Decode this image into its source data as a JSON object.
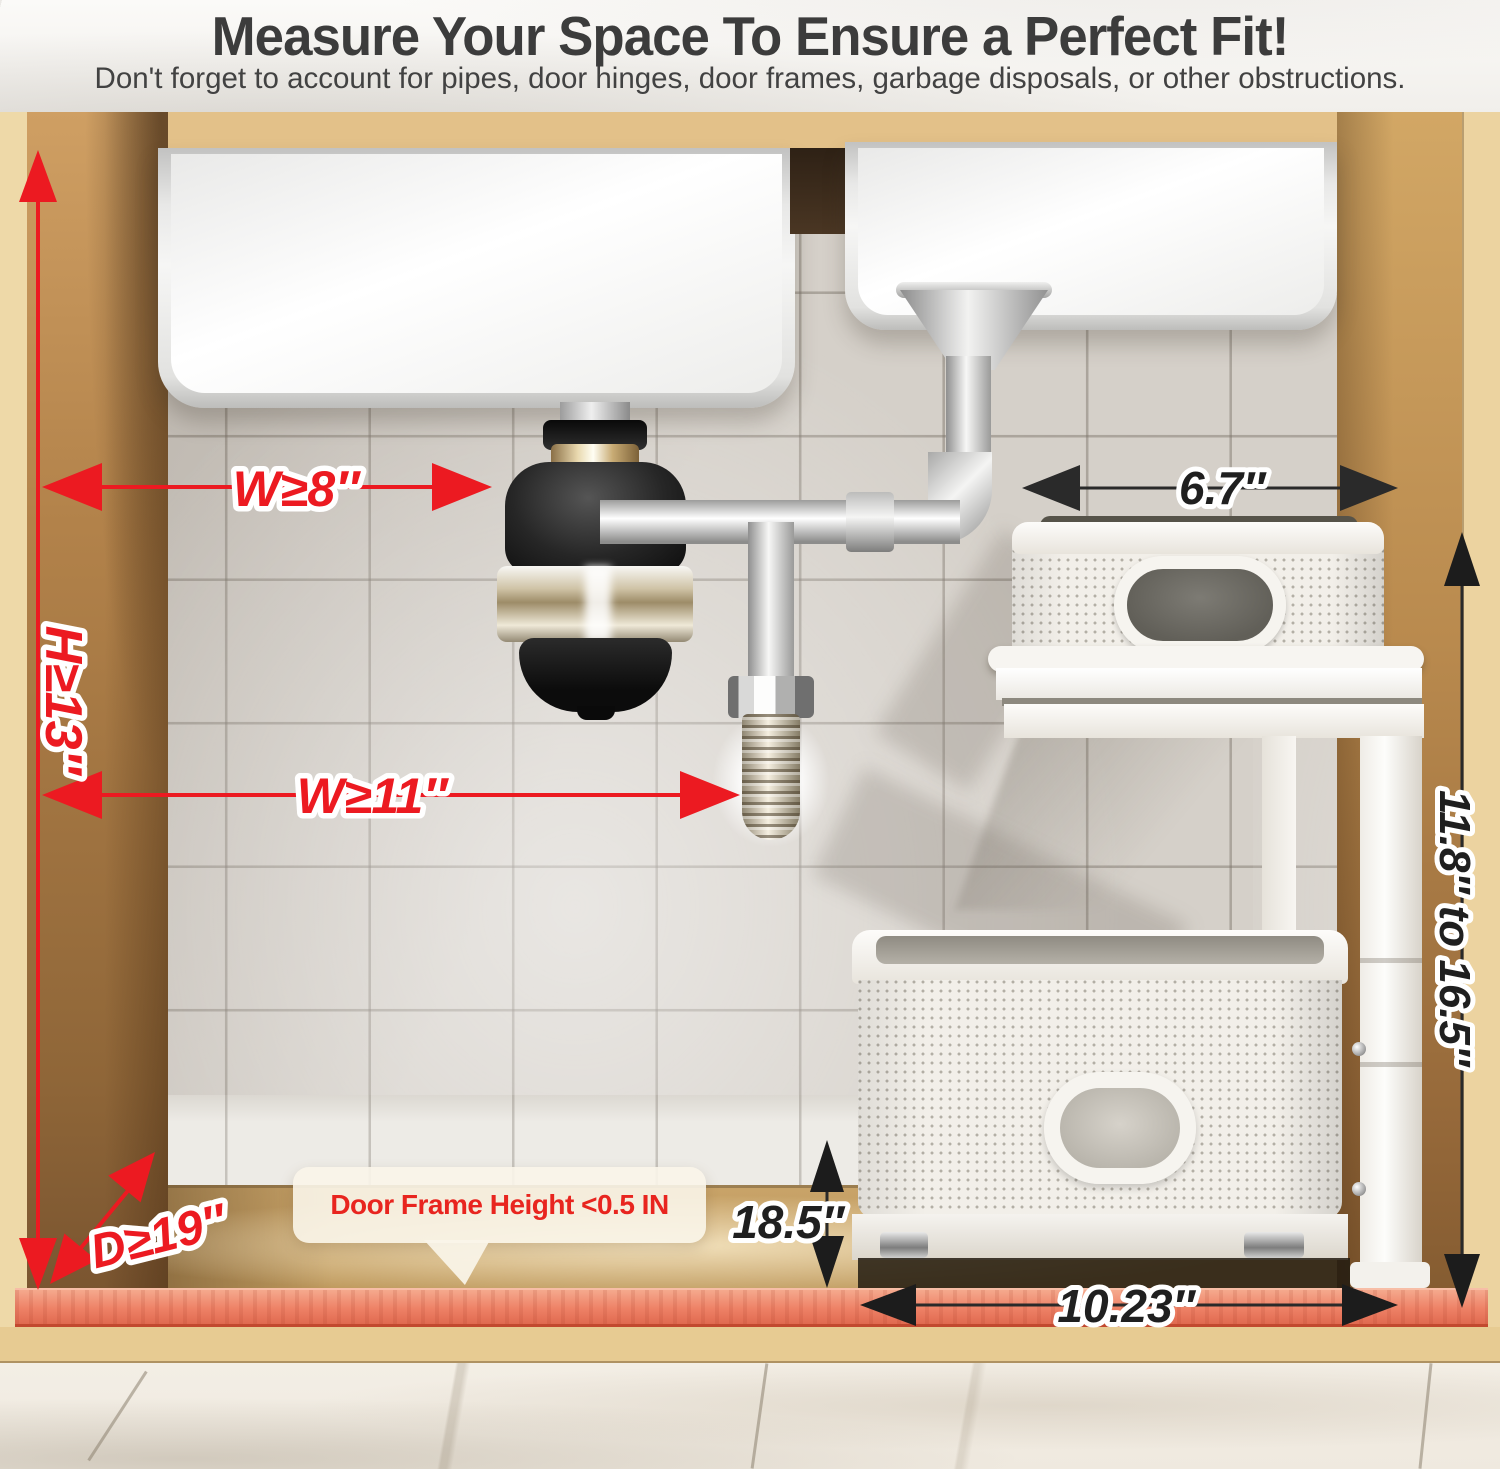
{
  "header": {
    "title": "Measure Your Space To Ensure a Perfect Fit!",
    "subtitle": "Don't forget to account for pipes, door hinges, door frames, garbage disposals, or other obstructions."
  },
  "dimensions": {
    "cabinet_width_at_disposal": "W≥8″",
    "cabinet_height": "H≥13″",
    "cabinet_width_lower": "W≥11″",
    "cabinet_depth": "D≥19″",
    "shelf_top_clearance": "6.7″",
    "adjustable_height_range": "11.8″ to 16.5″",
    "basket_side_clearance": "18.5″",
    "base_width": "10.23″"
  },
  "callout": {
    "door_frame_note": "Door Frame Height <0.5 IN"
  },
  "colors": {
    "accent_red": "#ec1a21",
    "label_black": "#1f1f1f",
    "door_frame_highlight": "#ee8166",
    "wood": "#dcb97f",
    "tile_wall": "#d5d0c9",
    "title_gray": "#3c3c3c"
  },
  "scene": {
    "description_names": [
      "under-sink-cabinet",
      "double-sink",
      "garbage-disposal",
      "drain-pipes",
      "two-tier-pullout-organizer",
      "mesh-baskets",
      "door-frame-strip",
      "marble-floor"
    ]
  }
}
